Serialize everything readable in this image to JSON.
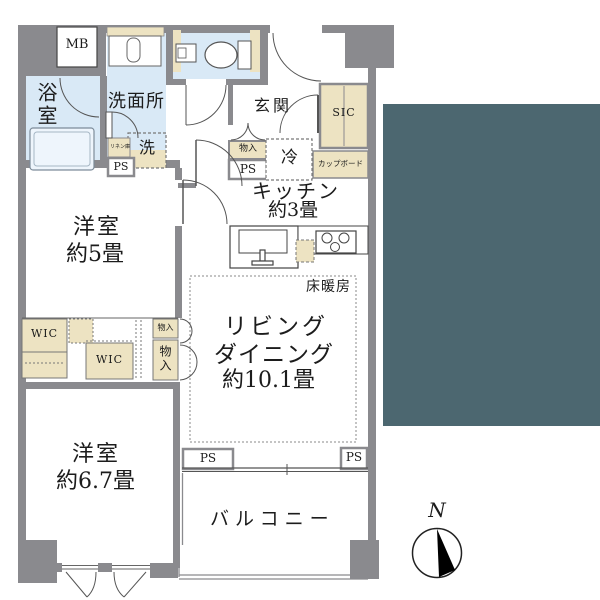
{
  "floor_plan": {
    "labels": {
      "meter_box": "MB",
      "bathroom": "浴室",
      "washroom": "洗面所",
      "washer": "洗",
      "linen_shelf": "リネン庫",
      "pipe_space": "PS",
      "entrance": "玄関",
      "shoe_closet": "SIC",
      "cupboard": "カップボード",
      "storage": "物入",
      "refrigerator": "冷",
      "kitchen": "キッチン",
      "kitchen_size": "約3畳",
      "floor_heating": "床暖房",
      "living": "リビング",
      "dining": "ダイニング",
      "living_size": "約10.1畳",
      "western_room": "洋室",
      "western_room1_size": "約5畳",
      "western_room2_size": "約6.7畳",
      "walk_in_closet": "WIC",
      "balcony": "バルコニー",
      "compass_north": "N"
    },
    "colors": {
      "wall_gray": "#8A8A8E",
      "wet_area_blue": "#D9E9F6",
      "fixture_tan": "#EDE3C2",
      "overlay_teal": "#4C6770",
      "line": "#555555"
    }
  }
}
